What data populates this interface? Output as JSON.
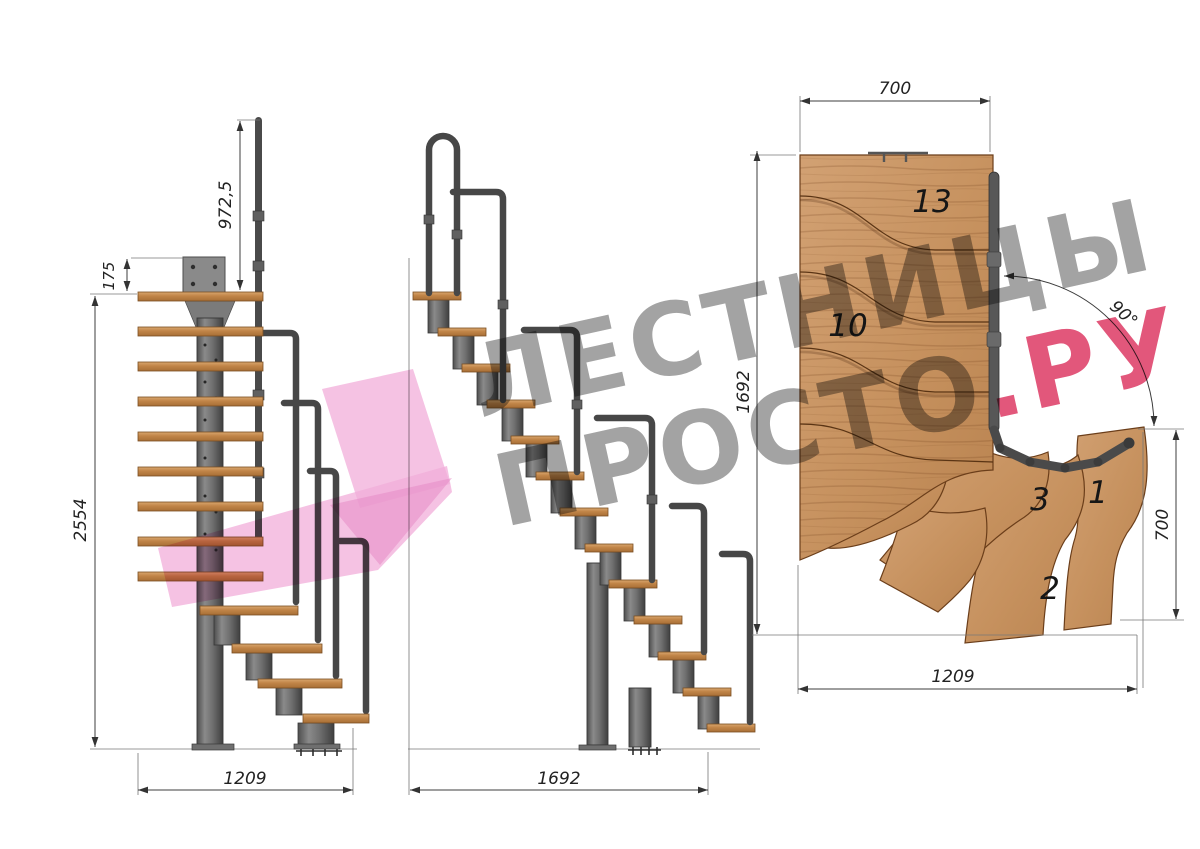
{
  "watermark": {
    "line1": "ЛЕСТНИЦЫ",
    "line2": "ПРОСТО",
    "accent": ".РУ"
  },
  "front_view": {
    "dim_rail_height": "972,5",
    "dim_plate": "175",
    "dim_total_height": "2554",
    "dim_width": "1209"
  },
  "side_view": {
    "dim_length": "1692"
  },
  "plan_view": {
    "dim_top_width": "700",
    "dim_length": "1692",
    "dim_turn_angle": "90°",
    "dim_right_width": "700",
    "dim_bottom_width": "1209",
    "step_13": "13",
    "step_10": "10",
    "step_3": "3",
    "step_1": "1",
    "step_2": "2"
  },
  "colors": {
    "wood": "#c99764",
    "wood_dark": "#a86f36",
    "metal": "#4f4f4f",
    "dimension_lines": "#3c3c3c",
    "watermark_gray": "#a3a3a3",
    "watermark_pink": "#e2577b",
    "logo_pink": "#f2aeda"
  }
}
